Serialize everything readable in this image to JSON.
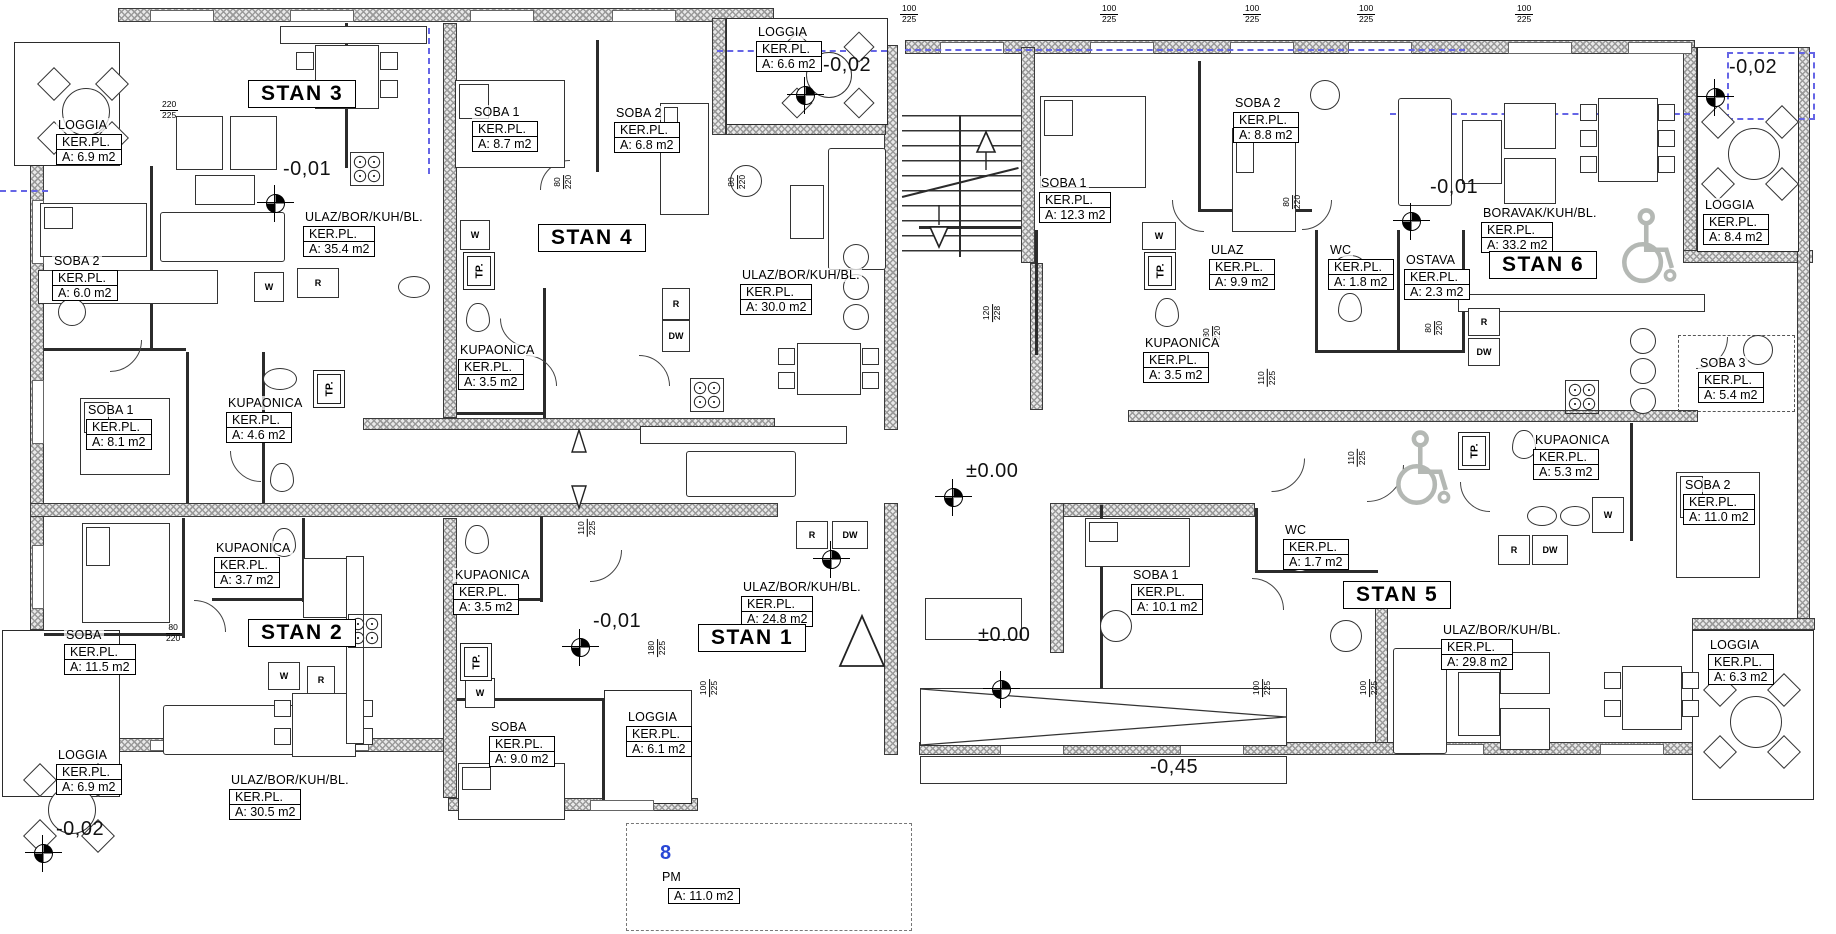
{
  "drawing_title": "Floor plan — apartments STAN 1 to STAN 6",
  "apartments": [
    {
      "label": "STAN 3",
      "x": 248,
      "y": 80
    },
    {
      "label": "STAN 4",
      "x": 538,
      "y": 224
    },
    {
      "label": "STAN 1",
      "x": 698,
      "y": 624
    },
    {
      "label": "STAN 2",
      "x": 248,
      "y": 619
    },
    {
      "label": "STAN 6",
      "x": 1489,
      "y": 251
    },
    {
      "label": "STAN 5",
      "x": 1343,
      "y": 581
    }
  ],
  "rooms": [
    {
      "name": "LOGGIA",
      "ker": "KER.PL.",
      "area": "A: 6.9 m2",
      "x": 56,
      "y": 116
    },
    {
      "name": "ULAZ/BOR/KUH/BL.",
      "ker": "KER.PL.",
      "area": "A: 35.4 m2",
      "x": 303,
      "y": 208
    },
    {
      "name": "SOBA 2",
      "ker": "KER.PL.",
      "area": "A: 6.0 m2",
      "x": 52,
      "y": 252
    },
    {
      "name": "SOBA 1",
      "ker": "KER.PL.",
      "area": "A: 8.7 m2",
      "x": 472,
      "y": 103
    },
    {
      "name": "SOBA 2",
      "ker": "KER.PL.",
      "area": "A: 6.8 m2",
      "x": 614,
      "y": 104
    },
    {
      "name": "LOGGIA",
      "ker": "KER.PL.",
      "area": "A: 6.6 m2",
      "x": 756,
      "y": 23
    },
    {
      "name": "KUPAONICA",
      "ker": "KER.PL.",
      "area": "A: 3.5 m2",
      "x": 458,
      "y": 341
    },
    {
      "name": "ULAZ/BOR/KUH/BL.",
      "ker": "KER.PL.",
      "area": "A: 30.0 m2",
      "x": 740,
      "y": 266
    },
    {
      "name": "SOBA 1",
      "ker": "KER.PL.",
      "area": "A: 8.1 m2",
      "x": 86,
      "y": 401
    },
    {
      "name": "KUPAONICA",
      "ker": "KER.PL.",
      "area": "A: 4.6 m2",
      "x": 226,
      "y": 394
    },
    {
      "name": "KUPAONICA",
      "ker": "KER.PL.",
      "area": "A: 3.7 m2",
      "x": 214,
      "y": 539
    },
    {
      "name": "SOBA",
      "ker": "KER.PL.",
      "area": "A: 11.5 m2",
      "x": 64,
      "y": 626
    },
    {
      "name": "LOGGIA",
      "ker": "KER.PL.",
      "area": "A: 6.9 m2",
      "x": 56,
      "y": 746
    },
    {
      "name": "ULAZ/BOR/KUH/BL.",
      "ker": "KER.PL.",
      "area": "A: 30.5 m2",
      "x": 229,
      "y": 771
    },
    {
      "name": "KUPAONICA",
      "ker": "KER.PL.",
      "area": "A: 3.5 m2",
      "x": 453,
      "y": 566
    },
    {
      "name": "ULAZ/BOR/KUH/BL.",
      "ker": "KER.PL.",
      "area": "A: 24.8 m2",
      "x": 741,
      "y": 578
    },
    {
      "name": "SOBA",
      "ker": "KER.PL.",
      "area": "A: 9.0 m2",
      "x": 489,
      "y": 718
    },
    {
      "name": "LOGGIA",
      "ker": "KER.PL.",
      "area": "A: 6.1 m2",
      "x": 626,
      "y": 708
    },
    {
      "name": "SOBA 1",
      "ker": "KER.PL.",
      "area": "A: 12.3 m2",
      "x": 1039,
      "y": 174
    },
    {
      "name": "SOBA 2",
      "ker": "KER.PL.",
      "area": "A: 8.8 m2",
      "x": 1233,
      "y": 94
    },
    {
      "name": "ULAZ",
      "ker": "KER.PL.",
      "area": "A: 9.9 m2",
      "x": 1209,
      "y": 241
    },
    {
      "name": "WC",
      "ker": "KER.PL.",
      "area": "A: 1.8 m2",
      "x": 1328,
      "y": 241
    },
    {
      "name": "OSTAVA",
      "ker": "KER.PL.",
      "area": "A: 2.3 m2",
      "x": 1404,
      "y": 251
    },
    {
      "name": "KUPAONICA",
      "ker": "KER.PL.",
      "area": "A: 3.5 m2",
      "x": 1143,
      "y": 334
    },
    {
      "name": "BORAVAK/KUH/BL.",
      "ker": "KER.PL.",
      "area": "A: 33.2 m2",
      "x": 1481,
      "y": 204
    },
    {
      "name": "LOGGIA",
      "ker": "KER.PL.",
      "area": "A: 8.4 m2",
      "x": 1703,
      "y": 196
    },
    {
      "name": "SOBA 3",
      "ker": "KER.PL.",
      "area": "A: 5.4 m2",
      "x": 1698,
      "y": 354
    },
    {
      "name": "KUPAONICA",
      "ker": "KER.PL.",
      "area": "A: 5.3 m2",
      "x": 1533,
      "y": 431
    },
    {
      "name": "SOBA 2",
      "ker": "KER.PL.",
      "area": "A: 11.0 m2",
      "x": 1683,
      "y": 476
    },
    {
      "name": "SOBA 1",
      "ker": "KER.PL.",
      "area": "A: 10.1 m2",
      "x": 1131,
      "y": 566
    },
    {
      "name": "WC",
      "ker": "KER.PL.",
      "area": "A: 1.7 m2",
      "x": 1283,
      "y": 521
    },
    {
      "name": "ULAZ/BOR/KUH/BL.",
      "ker": "KER.PL.",
      "area": "A: 29.8 m2",
      "x": 1441,
      "y": 621
    },
    {
      "name": "LOGGIA",
      "ker": "KER.PL.",
      "area": "A: 6.3 m2",
      "x": 1708,
      "y": 636
    }
  ],
  "elevations": [
    {
      "text": "-0,01",
      "x": 283,
      "y": 158
    },
    {
      "text": "-0,02",
      "x": 823,
      "y": 54
    },
    {
      "text": "-0,01",
      "x": 593,
      "y": 610
    },
    {
      "text": "-0,02",
      "x": 56,
      "y": 818
    },
    {
      "text": "±0.00",
      "x": 966,
      "y": 460
    },
    {
      "text": "±0.00",
      "x": 978,
      "y": 624
    },
    {
      "text": "-0,01",
      "x": 1430,
      "y": 176
    },
    {
      "text": "-0,02",
      "x": 1729,
      "y": 56
    },
    {
      "text": "-0,45",
      "x": 1150,
      "y": 756
    }
  ],
  "markers": [
    {
      "x": 266,
      "y": 194
    },
    {
      "x": 796,
      "y": 86
    },
    {
      "x": 944,
      "y": 488
    },
    {
      "x": 822,
      "y": 550
    },
    {
      "x": 571,
      "y": 638
    },
    {
      "x": 1402,
      "y": 212
    },
    {
      "x": 1706,
      "y": 88
    },
    {
      "x": 34,
      "y": 844
    },
    {
      "x": 992,
      "y": 680
    }
  ],
  "dims": [
    {
      "top": "220",
      "bottom": "225",
      "x": 160,
      "y": 100,
      "vertical": false
    },
    {
      "top": "100",
      "bottom": "225",
      "x": 900,
      "y": 4,
      "vertical": false
    },
    {
      "top": "100",
      "bottom": "225",
      "x": 1100,
      "y": 4,
      "vertical": false
    },
    {
      "top": "100",
      "bottom": "225",
      "x": 1243,
      "y": 4,
      "vertical": false
    },
    {
      "top": "100",
      "bottom": "225",
      "x": 1357,
      "y": 4,
      "vertical": false
    },
    {
      "top": "100",
      "bottom": "225",
      "x": 1515,
      "y": 4,
      "vertical": false
    },
    {
      "top": "120",
      "bottom": "228",
      "x": 983,
      "y": 303,
      "vertical": true
    },
    {
      "top": "110",
      "bottom": "225",
      "x": 1258,
      "y": 368,
      "vertical": true
    },
    {
      "top": "110",
      "bottom": "225",
      "x": 1348,
      "y": 448,
      "vertical": true
    },
    {
      "top": "110",
      "bottom": "225",
      "x": 578,
      "y": 518,
      "vertical": true
    },
    {
      "top": "180",
      "bottom": "225",
      "x": 648,
      "y": 638,
      "vertical": true
    },
    {
      "top": "100",
      "bottom": "225",
      "x": 700,
      "y": 678,
      "vertical": true
    },
    {
      "top": "100",
      "bottom": "225",
      "x": 1253,
      "y": 678,
      "vertical": true
    },
    {
      "top": "100",
      "bottom": "225",
      "x": 1360,
      "y": 678,
      "vertical": true
    },
    {
      "top": "80",
      "bottom": "220",
      "x": 556,
      "y": 172,
      "vertical": true
    },
    {
      "top": "80",
      "bottom": "220",
      "x": 730,
      "y": 172,
      "vertical": true
    },
    {
      "top": "80",
      "bottom": "220",
      "x": 1285,
      "y": 192,
      "vertical": true
    },
    {
      "top": "80",
      "bottom": "220",
      "x": 1205,
      "y": 323,
      "vertical": true
    },
    {
      "top": "80",
      "bottom": "220",
      "x": 1427,
      "y": 318,
      "vertical": true
    },
    {
      "top": "80",
      "bottom": "220",
      "x": 166,
      "y": 623,
      "vertical": false
    }
  ],
  "tp_units": [
    {
      "label": "TP.",
      "x": 463,
      "y": 252
    },
    {
      "label": "TP.",
      "x": 313,
      "y": 370
    },
    {
      "label": "TP.",
      "x": 460,
      "y": 643
    },
    {
      "label": "TP.",
      "x": 1144,
      "y": 252
    },
    {
      "label": "TP.",
      "x": 1458,
      "y": 432
    }
  ],
  "appliances": [
    {
      "label": "W",
      "x": 254,
      "y": 272,
      "w": 28,
      "h": 28
    },
    {
      "label": "R",
      "x": 297,
      "y": 268,
      "w": 40,
      "h": 28
    },
    {
      "label": "W",
      "x": 460,
      "y": 220,
      "w": 28,
      "h": 28
    },
    {
      "label": "R",
      "x": 662,
      "y": 288,
      "w": 26,
      "h": 30
    },
    {
      "label": "DW",
      "x": 662,
      "y": 320,
      "w": 26,
      "h": 30
    },
    {
      "label": "W",
      "x": 465,
      "y": 678,
      "w": 28,
      "h": 28
    },
    {
      "label": "R",
      "x": 796,
      "y": 521,
      "w": 30,
      "h": 26
    },
    {
      "label": "DW",
      "x": 832,
      "y": 521,
      "w": 34,
      "h": 26
    },
    {
      "label": "W",
      "x": 268,
      "y": 662,
      "w": 30,
      "h": 26
    },
    {
      "label": "R",
      "x": 307,
      "y": 666,
      "w": 26,
      "h": 26
    },
    {
      "label": "W",
      "x": 1142,
      "y": 222,
      "w": 32,
      "h": 26
    },
    {
      "label": "R",
      "x": 1468,
      "y": 308,
      "w": 30,
      "h": 26
    },
    {
      "label": "DW",
      "x": 1468,
      "y": 338,
      "w": 30,
      "h": 26
    },
    {
      "label": "R",
      "x": 1498,
      "y": 535,
      "w": 30,
      "h": 28
    },
    {
      "label": "DW",
      "x": 1532,
      "y": 535,
      "w": 34,
      "h": 28
    },
    {
      "label": "W",
      "x": 1592,
      "y": 497,
      "w": 30,
      "h": 34
    }
  ],
  "parking": {
    "number": "8",
    "code": "PM",
    "area": "A: 11.0 m2"
  },
  "accent_colors": {
    "section_line": "#6565e6",
    "parking_number": "#2947d6",
    "wheelchair": "#b4b8b4"
  }
}
